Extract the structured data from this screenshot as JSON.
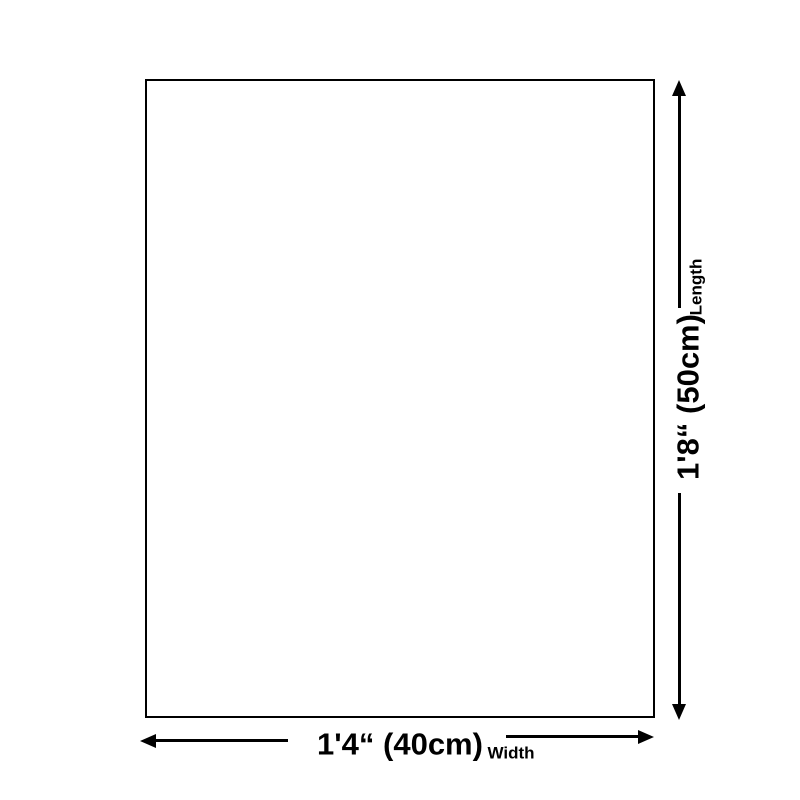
{
  "diagram": {
    "length": {
      "value": "1'8“ (50cm)",
      "label": "Length"
    },
    "width": {
      "value": "1'4“ (40cm)",
      "label": "Width"
    }
  },
  "colors": {
    "line": "#000000",
    "background": "#ffffff"
  }
}
